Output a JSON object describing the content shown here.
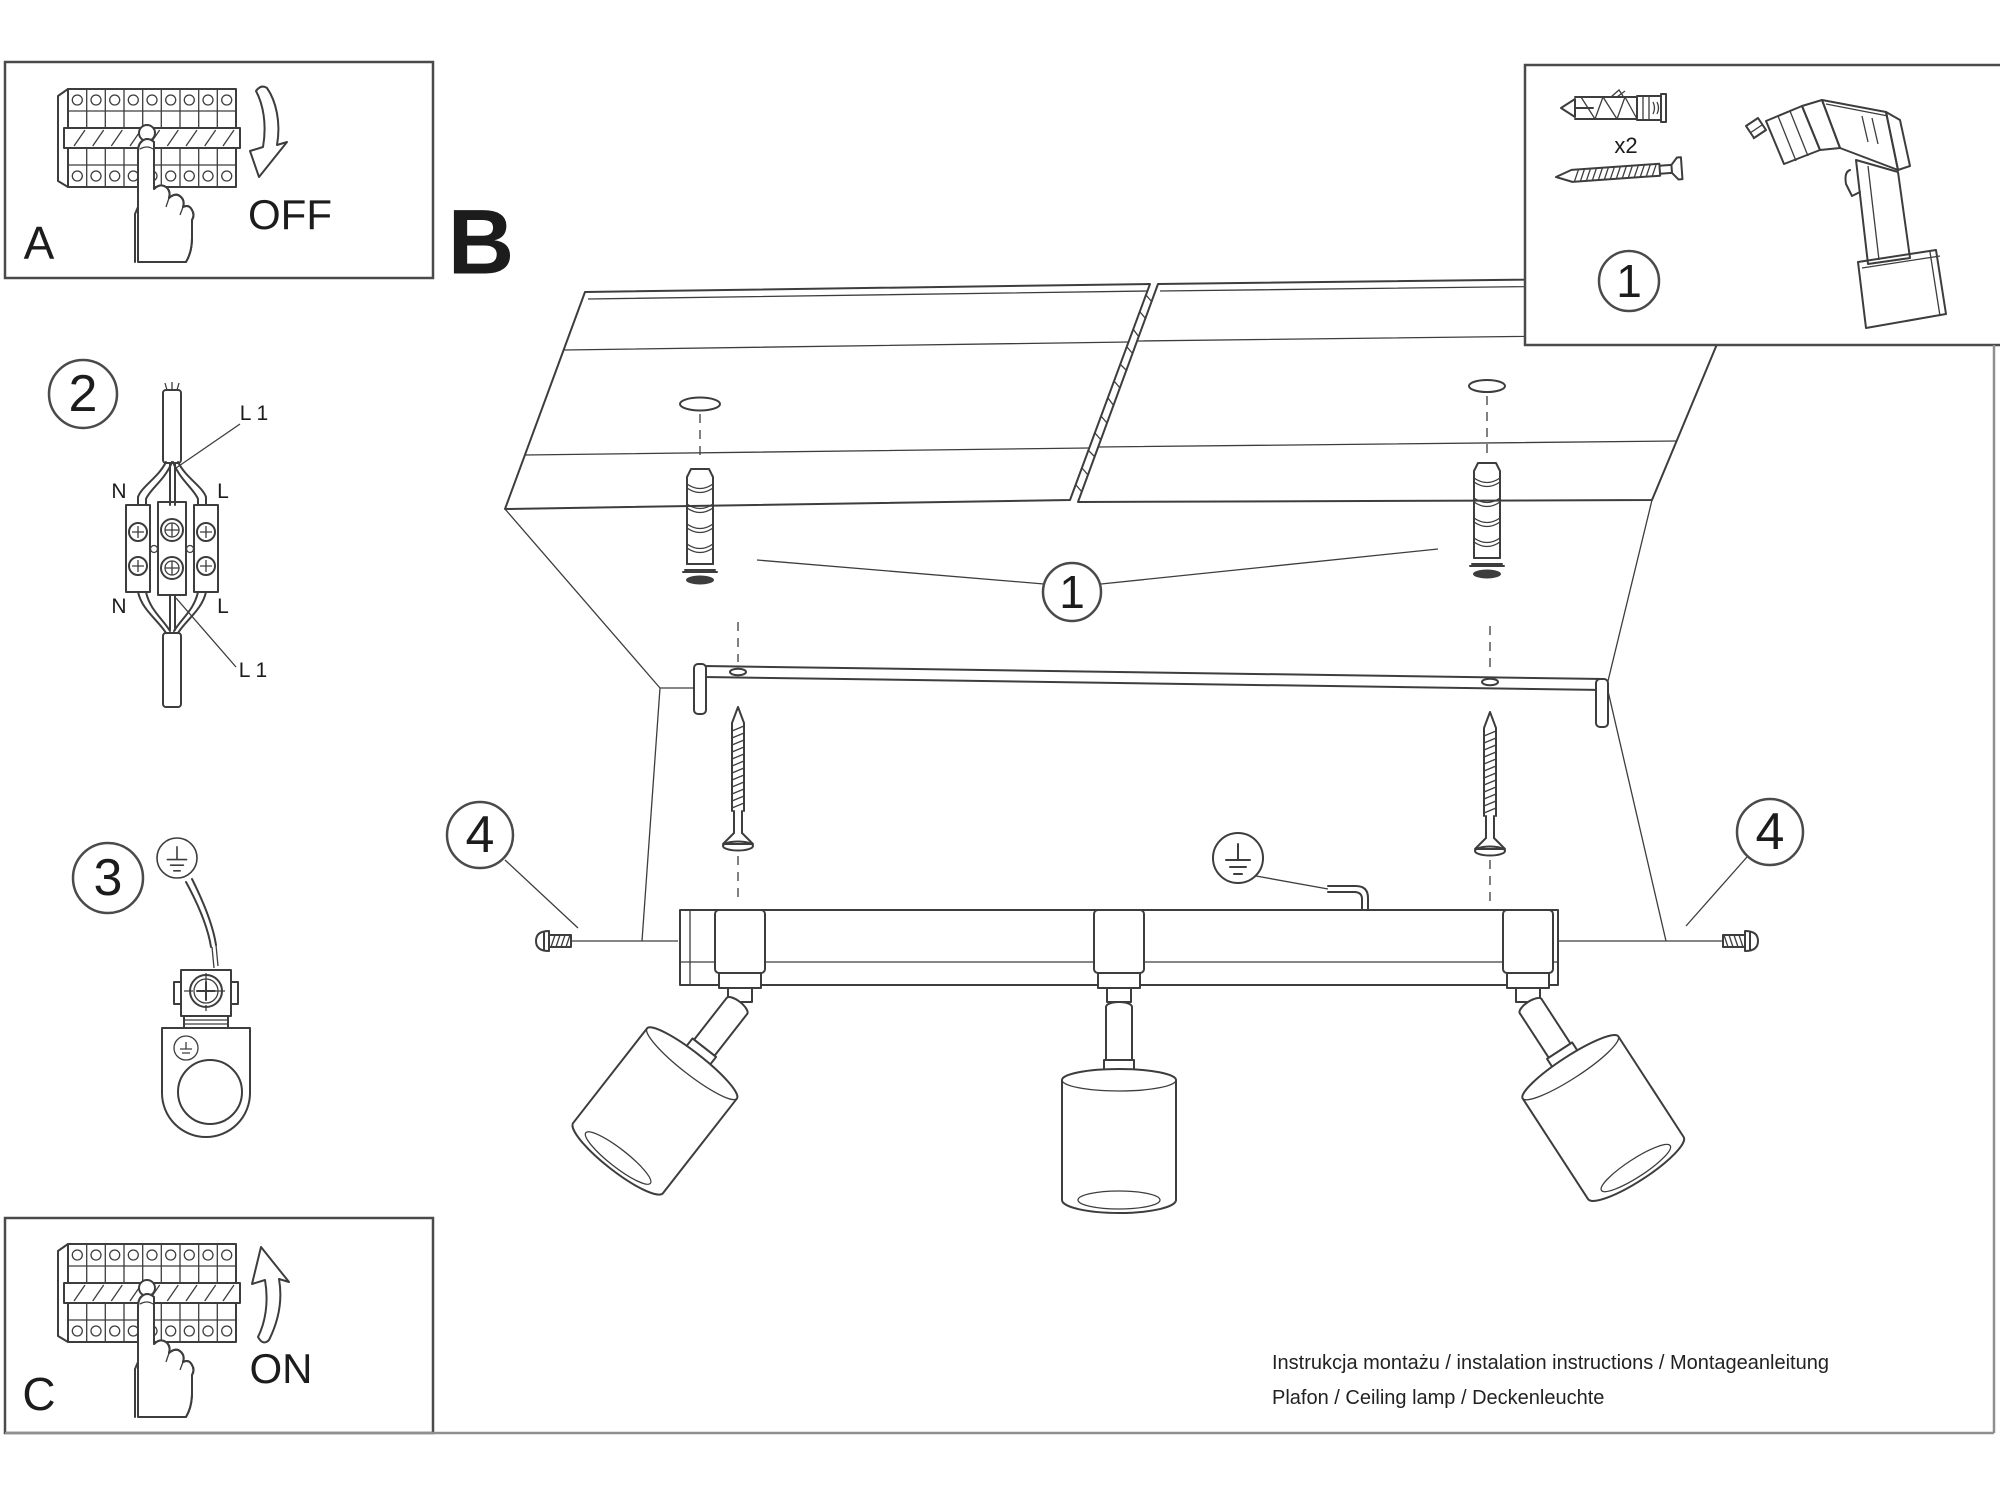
{
  "sections": {
    "a_label": "A",
    "b_label": "B",
    "c_label": "C"
  },
  "breaker": {
    "off_label": "OFF",
    "on_label": "ON"
  },
  "markers": {
    "step1": "1",
    "step2": "2",
    "step3": "3",
    "step4": "4"
  },
  "parts": {
    "dowel_qty": "x2"
  },
  "wiring": {
    "l1_top": "L 1",
    "l1_bottom": "L 1",
    "n_top": "N",
    "l_top": "L",
    "n_bottom": "N",
    "l_bottom": "L"
  },
  "footer": {
    "line1": "Instrukcja montażu / instalation instructions / Montageanleitung",
    "line2": "Plafon / Ceiling lamp / Deckenleuchte"
  },
  "colors": {
    "line": "#3d3d3d",
    "page_border": "#8f8f8f",
    "text": "#1c1c1c",
    "background": "#ffffff"
  }
}
